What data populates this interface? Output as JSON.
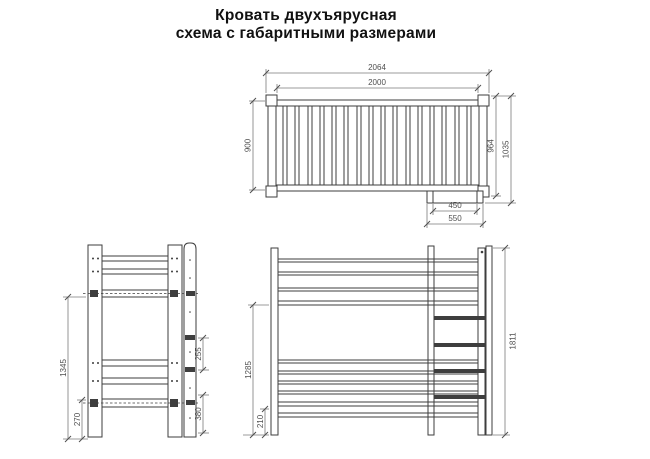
{
  "title": {
    "line1": "Кровать двухъярусная",
    "line2": "схема с габаритными размерами"
  },
  "colors": {
    "background": "#ffffff",
    "drawing_line": "#3e3e3e",
    "dimension_line": "#7a7a7a",
    "dimension_text": "#4f4f4f",
    "title_text": "#111111"
  },
  "views": {
    "top": {
      "dims": {
        "outer_length": "2064",
        "inner_length": "2000",
        "inner_width": "900",
        "outer_width": "964",
        "total_width": "1035",
        "ladder_inner_width": "450",
        "ladder_outer_width": "550"
      }
    },
    "side": {
      "dims": {
        "upper_level_height": "1345",
        "lower_level_height": "270",
        "step_spacing": "255",
        "lower_step_height": "380"
      }
    },
    "front": {
      "dims": {
        "upper_clearance": "1285",
        "lower_clearance": "210",
        "total_height": "1811"
      }
    }
  }
}
